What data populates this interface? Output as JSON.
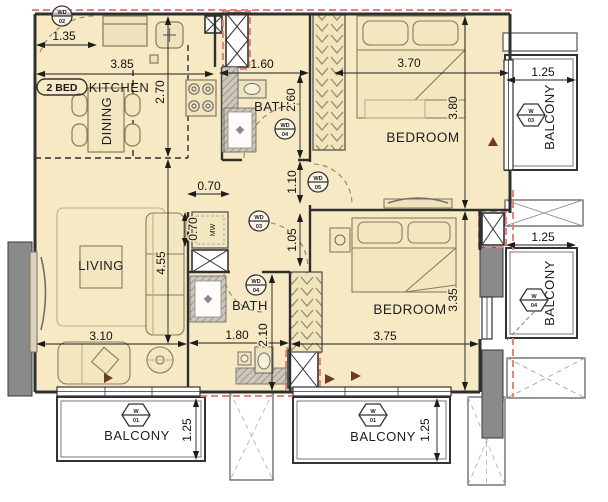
{
  "badge": {
    "label": "2 BED"
  },
  "rooms": {
    "kitchen": "KITCHEN",
    "dining": "DINING",
    "living": "LIVING",
    "bath_top": "BATH",
    "bath_bottom": "BATH",
    "bedroom_top": "BEDROOM",
    "bedroom_bottom": "BEDROOM",
    "balcony_top_right": "BALCONY",
    "balcony_mid_right": "BALCONY",
    "balcony_bottom_left": "BALCONY",
    "balcony_bottom_center": "BALCONY",
    "mw_closet": "MW"
  },
  "dimensions": {
    "entry_width": "1.35",
    "kitchen_width": "3.85",
    "kitchen_depth": "2.70",
    "bath_top_width": "1.60",
    "bath_top_depth": "2.60",
    "bedroom_top_width": "3.70",
    "bedroom_top_depth": "3.80",
    "balcony_top_right_width": "1.25",
    "closet_width": "0.70",
    "closet_depth": "0.70",
    "hall_upper": "1.10",
    "hall_lower": "1.05",
    "living_depth": "4.55",
    "living_width": "3.10",
    "bath_bottom_width": "1.80",
    "bath_bottom_depth": "2.10",
    "bedroom_bottom_width": "3.75",
    "bedroom_bottom_depth": "3.35",
    "balcony_mid_right_width": "1.25",
    "balcony_bottom_left_depth": "1.25",
    "balcony_bottom_center_depth": "1.25"
  },
  "door_tags": {
    "entry": {
      "line1": "WD",
      "line2": "02"
    },
    "bath_top": {
      "line1": "WD",
      "line2": "04"
    },
    "bedroom_top": {
      "line1": "WD",
      "line2": "05"
    },
    "hall": {
      "line1": "WD",
      "line2": "03"
    },
    "bath_bottom": {
      "line1": "WD",
      "line2": "04"
    }
  },
  "window_tags": {
    "balcony_top_right": {
      "line1": "W",
      "line2": "03"
    },
    "balcony_mid_right": {
      "line1": "W",
      "line2": "04"
    },
    "balcony_bottom_left": {
      "line1": "W",
      "line2": "01"
    },
    "balcony_bottom_center": {
      "line1": "W",
      "line2": "01"
    }
  },
  "colors": {
    "floor": "#f6e9c4",
    "wall": "#333333",
    "fire_dash": "#e8837a",
    "column": "#8a8a8a",
    "balcony_floor": "#ffffff"
  }
}
